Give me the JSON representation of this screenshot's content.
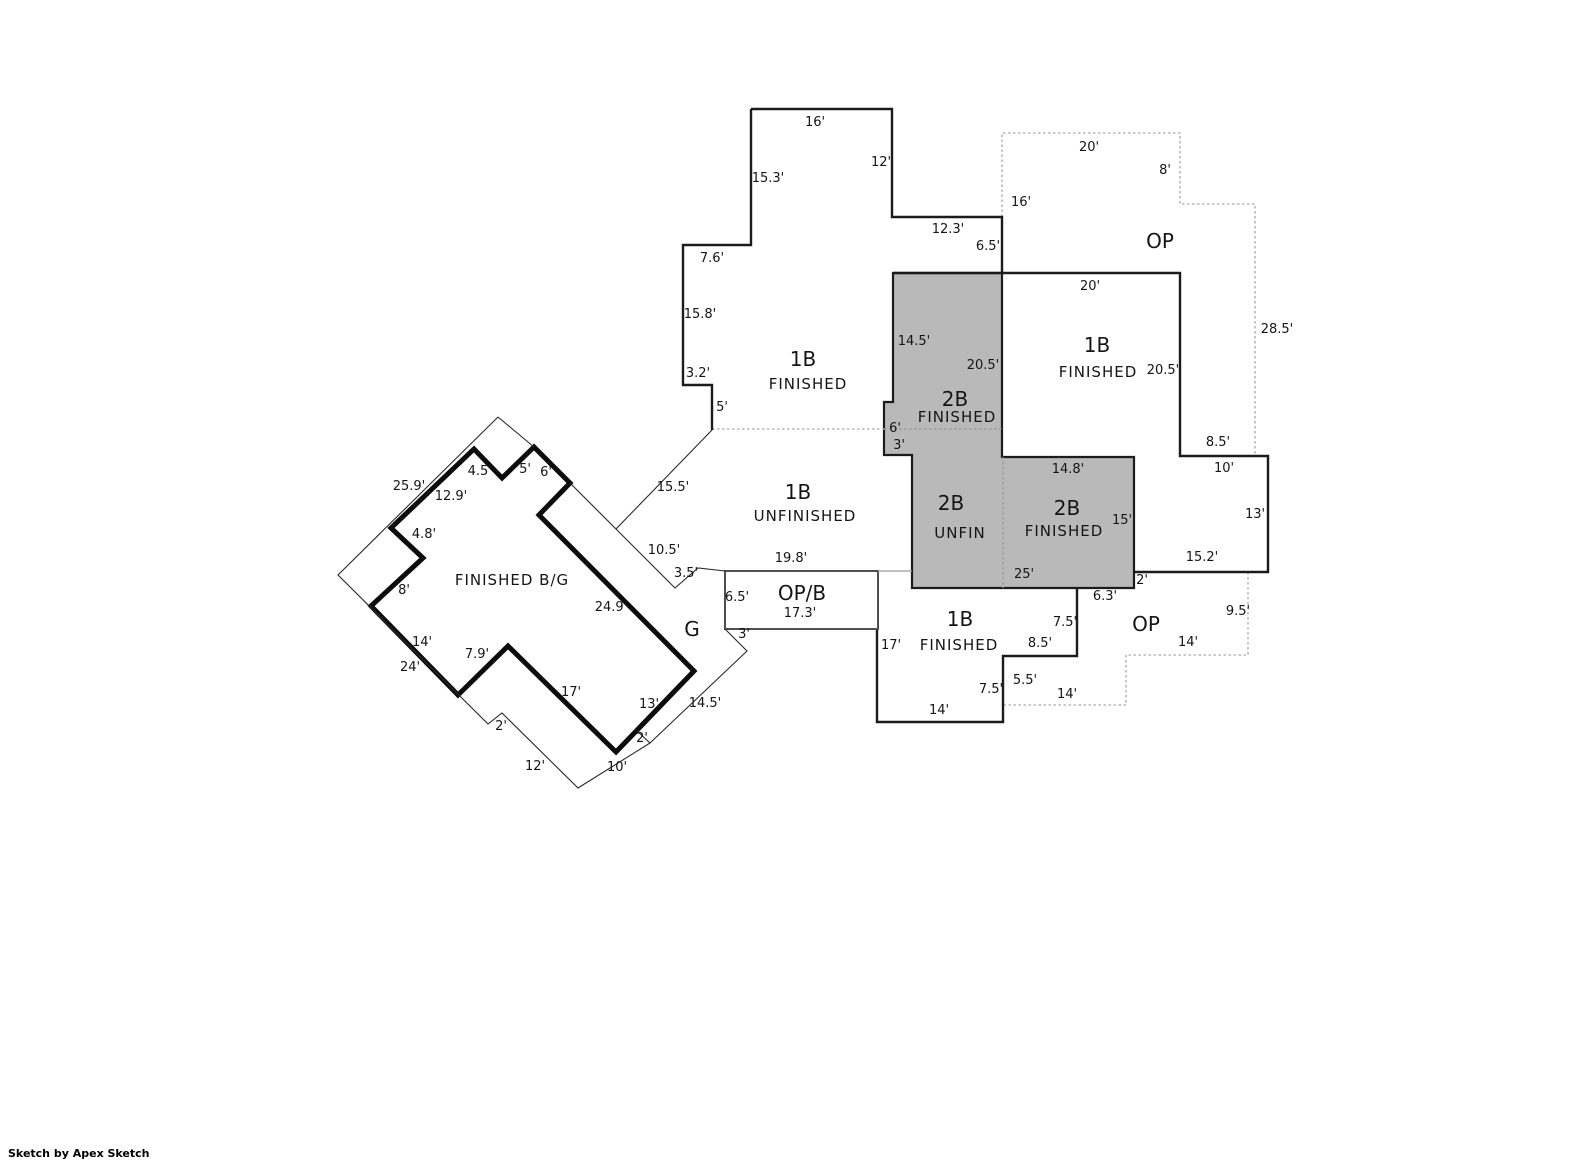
{
  "credit": "Sketch by Apex Sketch",
  "colors": {
    "gray_fill": "#b9b9b9",
    "wall": "#1b1b1b",
    "dotted": "#b8b8b8",
    "background": "#ffffff"
  },
  "room_labels": [
    {
      "t": "1B",
      "x": 803,
      "y": 366,
      "cls": "rm-lg",
      "name": "room-1b-finished-upper"
    },
    {
      "t": "FINISHED",
      "x": 808,
      "y": 389,
      "cls": "rm-md",
      "name": "room-1b-finished-upper"
    },
    {
      "t": "2B",
      "x": 955,
      "y": 406,
      "cls": "rm-lg",
      "name": "room-2b-finished-center"
    },
    {
      "t": "FINISHED",
      "x": 957,
      "y": 422,
      "cls": "rm-md",
      "name": "room-2b-finished-center"
    },
    {
      "t": "1B",
      "x": 1097,
      "y": 352,
      "cls": "rm-lg",
      "name": "room-1b-finished-right"
    },
    {
      "t": "FINISHED",
      "x": 1098,
      "y": 377,
      "cls": "rm-md",
      "name": "room-1b-finished-right"
    },
    {
      "t": "2B",
      "x": 951,
      "y": 510,
      "cls": "rm-lg",
      "name": "room-2b-unfin"
    },
    {
      "t": "UNFIN",
      "x": 960,
      "y": 538,
      "cls": "rm-md",
      "name": "room-2b-unfin"
    },
    {
      "t": "2B",
      "x": 1067,
      "y": 515,
      "cls": "rm-lg",
      "name": "room-2b-finished-right"
    },
    {
      "t": "FINISHED",
      "x": 1064,
      "y": 536,
      "cls": "rm-md",
      "name": "room-2b-finished-right"
    },
    {
      "t": "1B",
      "x": 960,
      "y": 626,
      "cls": "rm-lg",
      "name": "room-1b-finished-lower"
    },
    {
      "t": "FINISHED",
      "x": 959,
      "y": 650,
      "cls": "rm-md",
      "name": "room-1b-finished-lower"
    },
    {
      "t": "1B",
      "x": 798,
      "y": 499,
      "cls": "rm-lg",
      "name": "room-1b-unfinished"
    },
    {
      "t": "UNFINISHED",
      "x": 805,
      "y": 521,
      "cls": "rm-md",
      "name": "room-1b-unfinished"
    },
    {
      "t": "OP",
      "x": 1160,
      "y": 248,
      "cls": "rm-lg",
      "name": "room-op-upper"
    },
    {
      "t": "OP",
      "x": 1146,
      "y": 631,
      "cls": "rm-lg",
      "name": "room-op-lower"
    },
    {
      "t": "OP/B",
      "x": 802,
      "y": 600,
      "cls": "rm-lg",
      "name": "room-op-b"
    },
    {
      "t": "17.3'",
      "x": 800,
      "y": 617,
      "cls": "dim",
      "name": "room-op-b-dimension"
    },
    {
      "t": "G",
      "x": 692,
      "y": 636,
      "cls": "rm-lg",
      "name": "room-garage"
    },
    {
      "t": "FINISHED B/G",
      "x": 512,
      "y": 585,
      "cls": "rm-md",
      "name": "room-finished-bg"
    }
  ],
  "dimensions": [
    {
      "t": "16'",
      "x": 815,
      "y": 126
    },
    {
      "t": "12'",
      "x": 881,
      "y": 166
    },
    {
      "t": "15.3'",
      "x": 768,
      "y": 182
    },
    {
      "t": "12.3'",
      "x": 948,
      "y": 233
    },
    {
      "t": "6.5'",
      "x": 988,
      "y": 250
    },
    {
      "t": "7.6'",
      "x": 712,
      "y": 262
    },
    {
      "t": "15.8'",
      "x": 700,
      "y": 318
    },
    {
      "t": "3.2'",
      "x": 698,
      "y": 377
    },
    {
      "t": "5'",
      "x": 722,
      "y": 411
    },
    {
      "t": "20'",
      "x": 1089,
      "y": 151
    },
    {
      "t": "8'",
      "x": 1165,
      "y": 174
    },
    {
      "t": "16'",
      "x": 1021,
      "y": 206
    },
    {
      "t": "28.5'",
      "x": 1277,
      "y": 333
    },
    {
      "t": "20'",
      "x": 1090,
      "y": 290
    },
    {
      "t": "20.5'",
      "x": 1163,
      "y": 374
    },
    {
      "t": "14.5'",
      "x": 914,
      "y": 345
    },
    {
      "t": "20.5'",
      "x": 983,
      "y": 369
    },
    {
      "t": "6'",
      "x": 895,
      "y": 432
    },
    {
      "t": "3'",
      "x": 899,
      "y": 449
    },
    {
      "t": "14.8'",
      "x": 1068,
      "y": 473
    },
    {
      "t": "15'",
      "x": 1122,
      "y": 524
    },
    {
      "t": "8.5'",
      "x": 1218,
      "y": 446
    },
    {
      "t": "10'",
      "x": 1224,
      "y": 472
    },
    {
      "t": "13'",
      "x": 1255,
      "y": 518
    },
    {
      "t": "15.2'",
      "x": 1202,
      "y": 561
    },
    {
      "t": "2'",
      "x": 1142,
      "y": 584
    },
    {
      "t": "6.3'",
      "x": 1105,
      "y": 600
    },
    {
      "t": "25'",
      "x": 1024,
      "y": 578
    },
    {
      "t": "9.5'",
      "x": 1238,
      "y": 615
    },
    {
      "t": "14'",
      "x": 1188,
      "y": 646
    },
    {
      "t": "7.5'",
      "x": 1065,
      "y": 626
    },
    {
      "t": "8.5'",
      "x": 1040,
      "y": 647
    },
    {
      "t": "5.5'",
      "x": 1025,
      "y": 684
    },
    {
      "t": "14'",
      "x": 1067,
      "y": 698
    },
    {
      "t": "7.5'",
      "x": 991,
      "y": 693
    },
    {
      "t": "14'",
      "x": 939,
      "y": 714
    },
    {
      "t": "17'",
      "x": 891,
      "y": 649
    },
    {
      "t": "19.8'",
      "x": 791,
      "y": 562
    },
    {
      "t": "6.5'",
      "x": 737,
      "y": 601
    },
    {
      "t": "3'",
      "x": 744,
      "y": 638
    },
    {
      "t": "3.5'",
      "x": 686,
      "y": 577
    },
    {
      "t": "10.5'",
      "x": 664,
      "y": 554
    },
    {
      "t": "15.5'",
      "x": 673,
      "y": 491
    },
    {
      "t": "25.9'",
      "x": 409,
      "y": 490
    },
    {
      "t": "12.9'",
      "x": 451,
      "y": 500
    },
    {
      "t": "4.5",
      "x": 478,
      "y": 475
    },
    {
      "t": "5'",
      "x": 525,
      "y": 473
    },
    {
      "t": "6'",
      "x": 546,
      "y": 476
    },
    {
      "t": "4.8'",
      "x": 424,
      "y": 538
    },
    {
      "t": "8'",
      "x": 404,
      "y": 594
    },
    {
      "t": "14'",
      "x": 422,
      "y": 646
    },
    {
      "t": "24'",
      "x": 410,
      "y": 671
    },
    {
      "t": "7.9'",
      "x": 477,
      "y": 658
    },
    {
      "t": "24.9'",
      "x": 611,
      "y": 611
    },
    {
      "t": "17'",
      "x": 571,
      "y": 696
    },
    {
      "t": "13'",
      "x": 649,
      "y": 708
    },
    {
      "t": "2'",
      "x": 501,
      "y": 730
    },
    {
      "t": "12'",
      "x": 535,
      "y": 770
    },
    {
      "t": "10'",
      "x": 617,
      "y": 771
    },
    {
      "t": "2'",
      "x": 642,
      "y": 742
    },
    {
      "t": "14.5'",
      "x": 705,
      "y": 707
    }
  ]
}
